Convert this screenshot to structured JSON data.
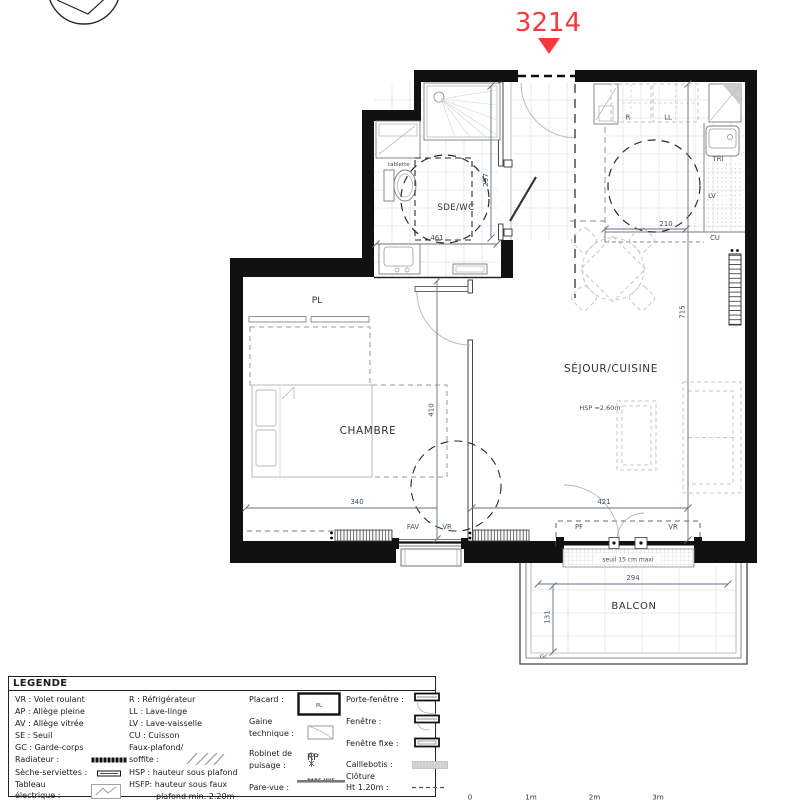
{
  "unit": {
    "number": "3214"
  },
  "colors": {
    "accent_red": "#f5393c"
  },
  "plan": {
    "rooms": {
      "sde_wc": "SDE/WC",
      "placard": "PL",
      "chambre": "CHAMBRE",
      "sejour_cuisine": "SÉJOUR/CUISINE",
      "balcon": "BALCON"
    },
    "annotations": {
      "tablette": "tablette",
      "hsp": "HSP ≈2.60m",
      "seuil": "seuil 15 cm maxi",
      "garde_corps": "GC",
      "fridge": "R",
      "washer": "LL",
      "tri": "TRI",
      "dishwasher": "LV",
      "cooktop": "CU",
      "window_fav": "FAV",
      "window_vr_chambre": "VR",
      "window_pf": "PF",
      "window_vr_sejour": "VR"
    },
    "dimensions": {
      "sde_height": "297",
      "sde_width": "461",
      "kitchen_width": "210",
      "sejour_height": "715",
      "chambre_height": "410",
      "chambre_width": "340",
      "sejour_width": "421",
      "balcon_width": "294",
      "balcon_depth": "131"
    }
  },
  "legend": {
    "title": "LEGENDE",
    "col1": [
      "VR : Volet roulant",
      "AP : Allège pleine",
      "AV : Allège vitrée",
      "SE : Seuil",
      "GC : Garde-corps",
      "Radiateur :",
      "Sèche-serviettes :",
      "Tableau",
      "électrique :"
    ],
    "col2": [
      "R : Réfrigérateur",
      "LL : Lave-linge",
      "LV : Lave-vaisselle",
      "CU : Cuisson",
      "Faux-plafond/",
      "soffite :",
      "HSP : hauteur sous plafond",
      "HSFP: hauteur sous faux",
      "plafond min. 2.20m"
    ],
    "col3": [
      "Placard :",
      "Gaine",
      "technique :",
      "Robinet de",
      "puisage :",
      "Pare-vue :"
    ],
    "col4": [
      "Porte-fenêtre :",
      "Fenêtre :",
      "Fenêtre fixe :",
      "Caillebotis :",
      "Clôture",
      "Ht 1.20m :"
    ],
    "icons": {
      "placard_label": "PL",
      "robinet_label": "RP",
      "parevue_label": "PARE-VUE"
    }
  },
  "scale_bar": {
    "labels": [
      "0",
      "1m",
      "2m",
      "3m"
    ]
  }
}
